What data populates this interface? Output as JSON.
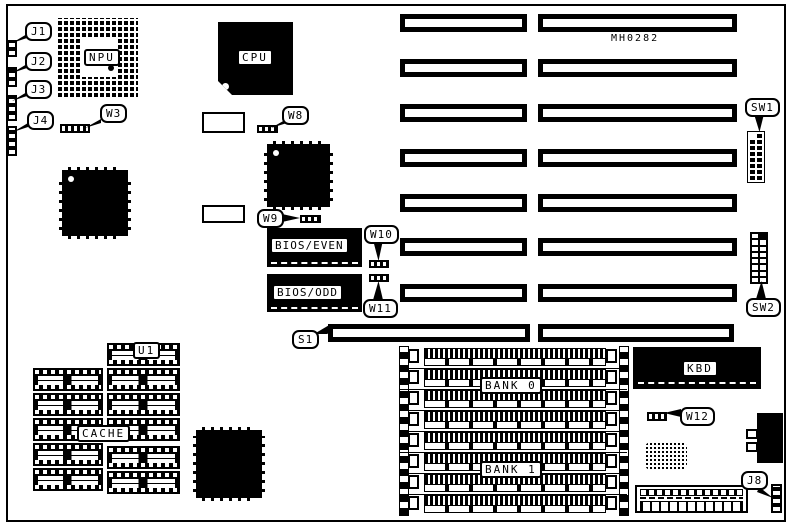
{
  "board": {
    "id_text": "MH0282"
  },
  "chips": {
    "npu": "NPU",
    "cpu": "CPU",
    "bios_even": "BIOS/EVEN",
    "bios_odd": "BIOS/ODD",
    "kbd": "KBD",
    "cache": "CACHE",
    "u1": "U1"
  },
  "memory": {
    "bank0": "BANK 0",
    "bank1": "BANK 1",
    "simm_rows": 8
  },
  "callouts": {
    "j1": "J1",
    "j2": "J2",
    "j3": "J3",
    "j4": "J4",
    "w3": "W3",
    "w8": "W8",
    "w9": "W9",
    "w10": "W10",
    "w11": "W11",
    "w12": "W12",
    "s1": "S1",
    "sw1": "SW1",
    "sw2": "SW2",
    "j8": "J8"
  },
  "slots": {
    "rows": 8
  },
  "switches": {
    "sw1": {
      "rows": 8,
      "cols": 2
    },
    "sw2": {
      "rows": 8,
      "cols": 2
    }
  },
  "cache_chips": {
    "left_column": 5,
    "right_column": 6
  },
  "colors": {
    "ink": "#000000",
    "paper": "#ffffff"
  }
}
